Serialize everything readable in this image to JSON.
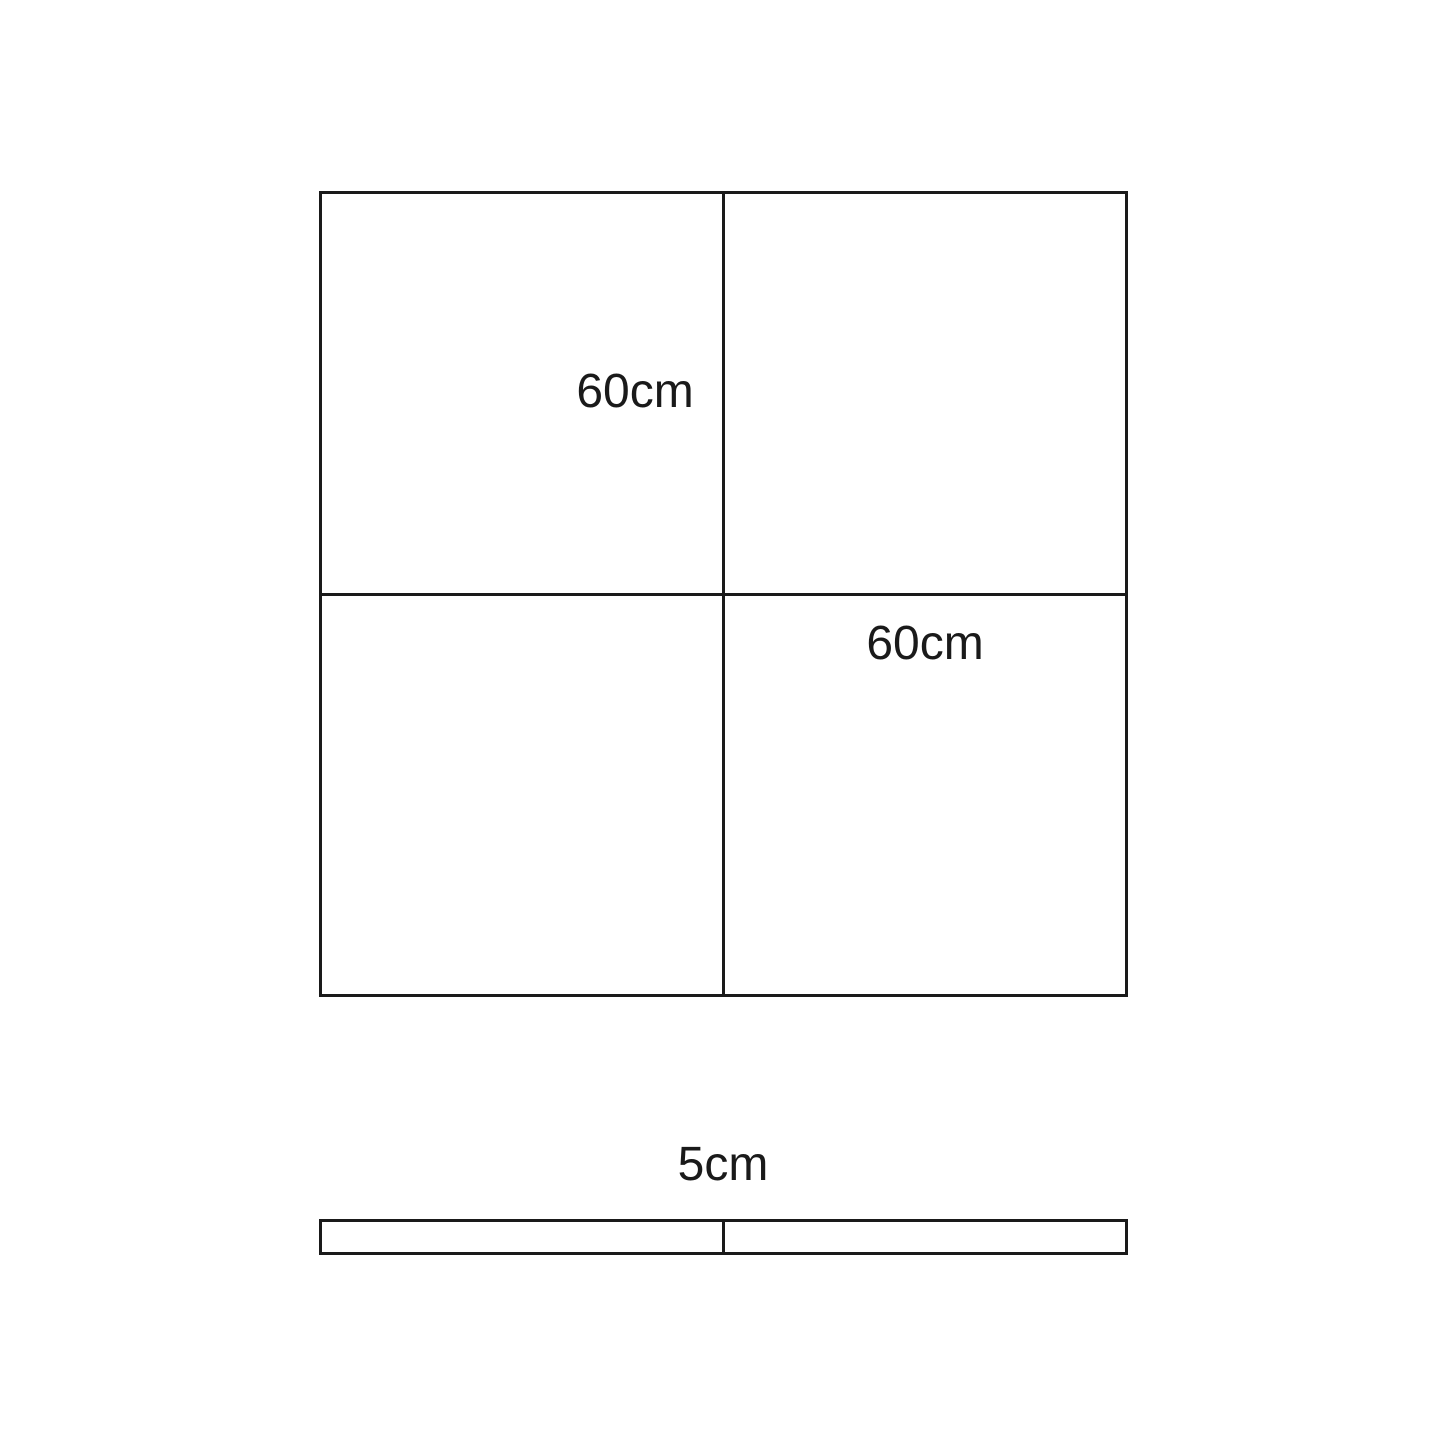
{
  "page": {
    "background": "#ffffff"
  },
  "diagram": {
    "line_color": "#1a1a1a",
    "large_square": {
      "top_left_quadrant_label": "60cm",
      "bottom_right_quadrant_label": "60cm"
    },
    "thin_bar": {
      "label": "5cm"
    }
  }
}
